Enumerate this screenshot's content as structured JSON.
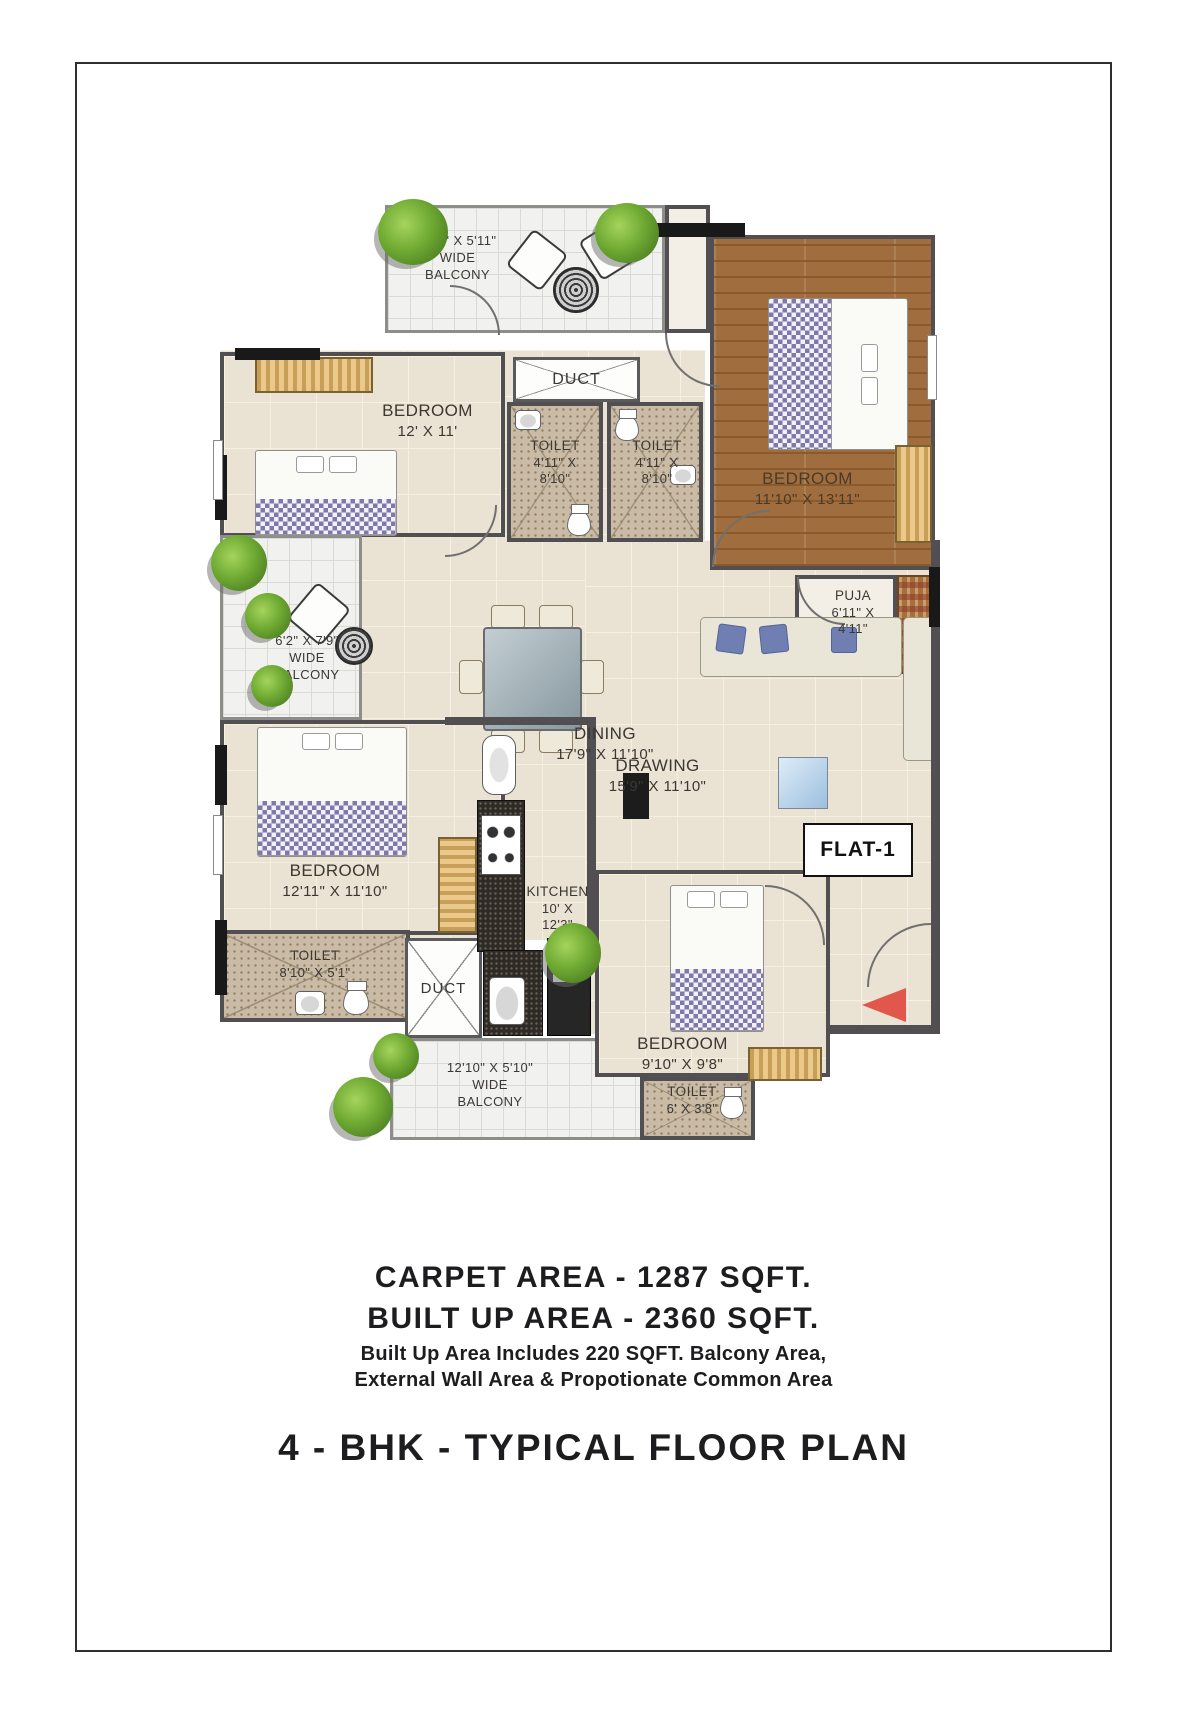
{
  "plan": {
    "flat_label": "FLAT-1",
    "rooms": {
      "balcony_top": {
        "l1": "14'7\" X 5'11\"",
        "l2": "WIDE",
        "l3": "BALCONY"
      },
      "duct_top": {
        "l1": "DUCT"
      },
      "bedroom_top_left": {
        "l1": "BEDROOM",
        "l2": "12' X 11'"
      },
      "toilet_left": {
        "l1": "TOILET",
        "l2": "4'11\" X",
        "l3": "8'10\""
      },
      "toilet_right": {
        "l1": "TOILET",
        "l2": "4'11\" X",
        "l3": "8'10\""
      },
      "bedroom_top_right": {
        "l1": "BEDROOM",
        "l2": "11'10\" X 13'11\""
      },
      "puja": {
        "l1": "PUJA",
        "l2": "6'11\" X",
        "l3": "4'11\""
      },
      "balcony_left": {
        "l1": "6'2\" X 7'9\"",
        "l2": "WIDE",
        "l3": "BALCONY"
      },
      "dining": {
        "l1": "DINING",
        "l2": "17'9\" X 11'10\""
      },
      "drawing": {
        "l1": "DRAWING",
        "l2": "15'9\" X 11'10\""
      },
      "bedroom_left": {
        "l1": "BEDROOM",
        "l2": "12'11\" X 11'10\""
      },
      "kitchen": {
        "l1": "KITCHEN",
        "l2": "10' X",
        "l3": "12'3\""
      },
      "toilet_bottom_left": {
        "l1": "TOILET",
        "l2": "8'10\" X 5'1\""
      },
      "duct_bottom": {
        "l1": "DUCT"
      },
      "balcony_bottom": {
        "l1": "12'10\" X 5'10\"",
        "l2": "WIDE",
        "l3": "BALCONY"
      },
      "bedroom_bottom": {
        "l1": "BEDROOM",
        "l2": "9'10\" X 9'8\""
      },
      "toilet_bottom_right": {
        "l1": "TOILET",
        "l2": "6' X 3'8\""
      }
    }
  },
  "footer": {
    "carpet_area": "CARPET AREA - 1287 SQFT.",
    "built_up_area": "BUILT UP AREA - 2360 SQFT.",
    "note_line1": "Built Up Area Includes 220 SQFT. Balcony Area,",
    "note_line2": "External Wall Area & Propotionate Common Area",
    "title": "4 - BHK - TYPICAL FLOOR PLAN"
  },
  "colors": {
    "wall": "#514f52",
    "floor_tile": "#eae2d2",
    "wood_floor": "#a06e3e",
    "toilet_floor": "#c9bba5",
    "balcony_floor": "#f1f1ef",
    "wardrobe": "#ecc98b",
    "entrance_accent": "#e2574c"
  }
}
